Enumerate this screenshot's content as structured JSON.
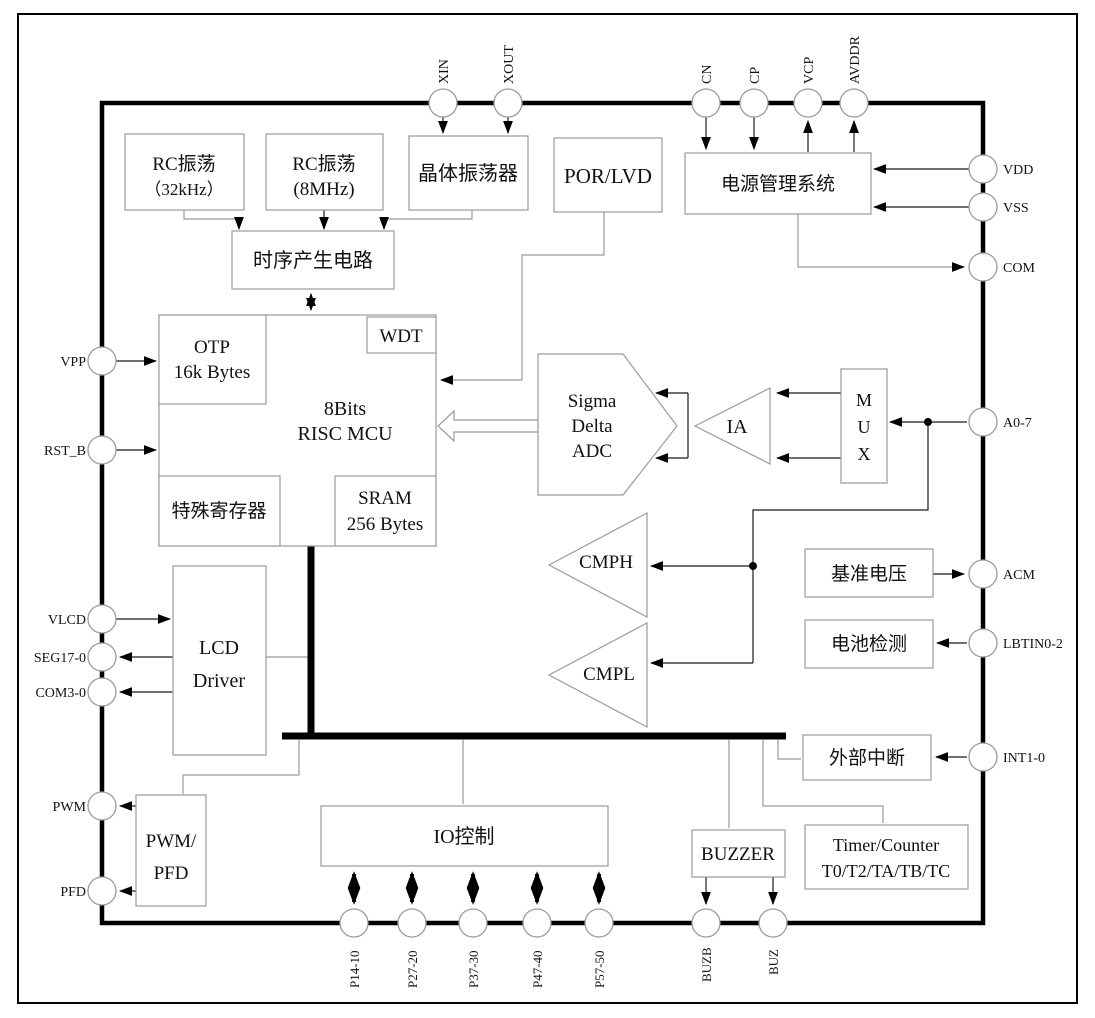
{
  "diagram": {
    "title": "MCU block diagram",
    "blocks": {
      "rc_osc_32k": {
        "line1": "RC振荡",
        "line2": "（32kHz）"
      },
      "rc_osc_8m": {
        "line1": "RC振荡",
        "line2": "(8MHz)"
      },
      "crystal_osc": {
        "label": "晶体振荡器"
      },
      "por_lvd": {
        "label": "POR/LVD"
      },
      "power_mgmt": {
        "label": "电源管理系统"
      },
      "timing_gen": {
        "label": "时序产生电路"
      },
      "mcu": {
        "line1": "8Bits",
        "line2": "RISC MCU"
      },
      "otp": {
        "line1": "OTP",
        "line2": "16k Bytes"
      },
      "wdt": {
        "label": "WDT"
      },
      "special_regs": {
        "label": "特殊寄存器"
      },
      "sram": {
        "line1": "SRAM",
        "line2": "256 Bytes"
      },
      "sigma_delta_adc": {
        "line1": "Sigma",
        "line2": "Delta",
        "line3": "ADC"
      },
      "ia": {
        "label": "IA"
      },
      "mux": {
        "line1": "M",
        "line2": "U",
        "line3": "X"
      },
      "cmph": {
        "label": "CMPH"
      },
      "cmpl": {
        "label": "CMPL"
      },
      "vref": {
        "label": "基准电压"
      },
      "battery_detect": {
        "label": "电池检测"
      },
      "ext_interrupt": {
        "label": "外部中断"
      },
      "lcd_driver": {
        "line1": "LCD",
        "line2": "Driver"
      },
      "pwm_pfd": {
        "line1": "PWM/",
        "line2": "PFD"
      },
      "io_control": {
        "label": "IO控制"
      },
      "buzzer": {
        "label": "BUZZER"
      },
      "timer_counter": {
        "line1": "Timer/Counter",
        "line2": "T0/T2/TA/TB/TC"
      }
    },
    "pins": {
      "top": [
        "XIN",
        "XOUT",
        "CN",
        "CP",
        "VCP",
        "AVDDR"
      ],
      "right": [
        "VDD",
        "VSS",
        "COM",
        "A0-7",
        "ACM",
        "LBTIN0-2",
        "INT1-0"
      ],
      "left": [
        "VPP",
        "RST_B",
        "VLCD",
        "SEG17-0",
        "COM3-0",
        "PWM",
        "PFD"
      ],
      "bottom": [
        "P14-10",
        "P27-20",
        "P37-30",
        "P47-40",
        "P57-50",
        "BUZB",
        "BUZ"
      ]
    },
    "colors": {
      "ink": "#000000",
      "box_stroke": "#9b9b9b",
      "wire": "#9a9a9a",
      "background": "#ffffff"
    }
  }
}
